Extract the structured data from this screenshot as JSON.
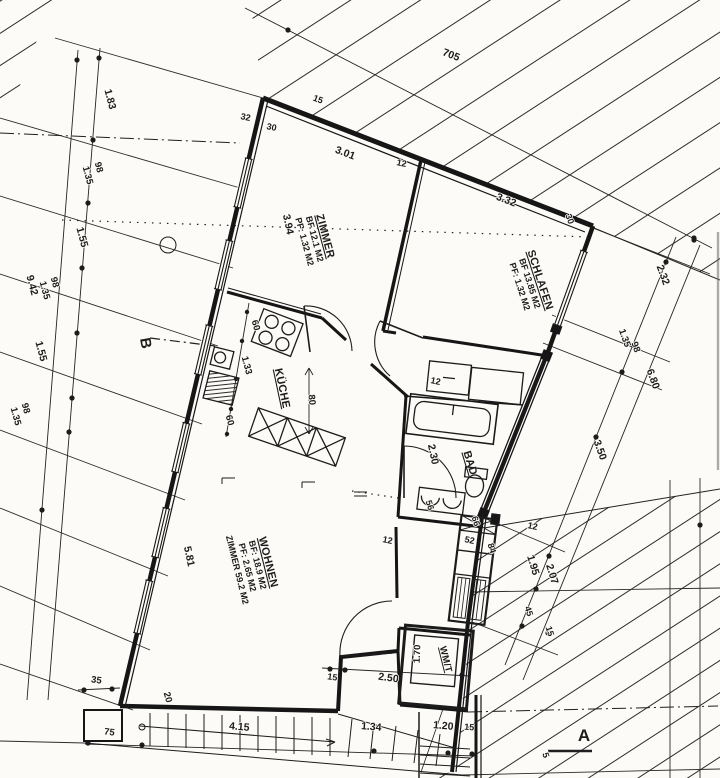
{
  "drawing": {
    "type": "apartment floor plan (scanned blueprint)",
    "ink_color": "#1c1c1c",
    "paper_color": "#fcfbf8"
  },
  "rooms": [
    {
      "id": "zimmer",
      "name": "ZIMMER",
      "lines": [
        "ZIMMER",
        "BF 12.1 M2",
        "PF: 1.32 M2"
      ],
      "x": 322,
      "y": 237,
      "r": 75
    },
    {
      "id": "schlafen",
      "name": "SCHLAFEN",
      "lines": [
        "SCHLAFEN",
        "BF 13.85 M2",
        "PF: 1.32 M2"
      ],
      "x": 537,
      "y": 281,
      "r": 72
    },
    {
      "id": "kueche",
      "name": "KÜCHE",
      "lines": [
        "KÜCHE"
      ],
      "x": 279,
      "y": 389,
      "r": 78
    },
    {
      "id": "bad",
      "name": "BAD",
      "lines": [
        "BAD"
      ],
      "x": 467,
      "y": 464,
      "r": 73
    },
    {
      "id": "wohnen",
      "name": "WOHNEN",
      "lines": [
        "WOHNEN",
        "BF: 18.9 M2",
        "PF: 2.65 M2",
        "ZIMMER 59.2 M2"
      ],
      "x": 265,
      "y": 563,
      "r": 76
    },
    {
      "id": "wmt",
      "name": "WM/T",
      "lines": [
        "WM/T"
      ],
      "x": 443,
      "y": 660,
      "r": 76,
      "fs": 9.5
    }
  ],
  "dims": [
    {
      "t": "705",
      "x": 450,
      "y": 58,
      "r": 21
    },
    {
      "t": "15",
      "x": 317,
      "y": 102,
      "r": 21,
      "fs": 9
    },
    {
      "t": "32",
      "x": 245,
      "y": 120,
      "r": 12,
      "fs": 9
    },
    {
      "t": "30",
      "x": 271,
      "y": 130,
      "r": 12,
      "fs": 9
    },
    {
      "t": "3.01",
      "x": 344,
      "y": 156,
      "r": 21
    },
    {
      "t": "12",
      "x": 401,
      "y": 166,
      "r": 12,
      "fs": 9
    },
    {
      "t": "3.32",
      "x": 505,
      "y": 203,
      "r": 21
    },
    {
      "t": "30",
      "x": 567,
      "y": 220,
      "r": 70,
      "fs": 9
    },
    {
      "t": "3.94",
      "x": 285,
      "y": 225,
      "r": 78
    },
    {
      "t": "2.32",
      "x": 660,
      "y": 276,
      "r": 70
    },
    {
      "t": "1.35",
      "x": 622,
      "y": 339,
      "r": 70,
      "fs": 9.5
    },
    {
      "t": "98",
      "x": 633,
      "y": 348,
      "r": 70,
      "fs": 9.5
    },
    {
      "t": "6.80",
      "x": 650,
      "y": 380,
      "r": 70
    },
    {
      "t": "3.50",
      "x": 597,
      "y": 451,
      "r": 70
    },
    {
      "t": "1.95",
      "x": 530,
      "y": 566,
      "r": 73
    },
    {
      "t": "2.07",
      "x": 549,
      "y": 575,
      "r": 73
    },
    {
      "t": "12",
      "x": 532,
      "y": 529,
      "r": 12,
      "fs": 9
    },
    {
      "t": "45",
      "x": 526,
      "y": 612,
      "r": 73,
      "fs": 9
    },
    {
      "t": "15",
      "x": 547,
      "y": 632,
      "r": 73,
      "fs": 9
    },
    {
      "t": "1.83",
      "x": 107,
      "y": 100,
      "r": 75
    },
    {
      "t": "98",
      "x": 96,
      "y": 168,
      "r": 75,
      "fs": 9.5
    },
    {
      "t": "1.35",
      "x": 85,
      "y": 176,
      "r": 75,
      "fs": 9.5
    },
    {
      "t": "1.55",
      "x": 79,
      "y": 238,
      "r": 75
    },
    {
      "t": "98",
      "x": 52,
      "y": 283,
      "r": 75,
      "fs": 9.5
    },
    {
      "t": "1.35",
      "x": 42,
      "y": 291,
      "r": 75,
      "fs": 9.5
    },
    {
      "t": "9.42",
      "x": 29,
      "y": 286,
      "r": 75
    },
    {
      "t": "1.55",
      "x": 38,
      "y": 352,
      "r": 75
    },
    {
      "t": "98",
      "x": 23,
      "y": 409,
      "r": 75,
      "fs": 9.5
    },
    {
      "t": "1.35",
      "x": 13,
      "y": 417,
      "r": 75,
      "fs": 9.5
    },
    {
      "t": "60",
      "x": 253,
      "y": 326,
      "r": 75,
      "fs": 9.5
    },
    {
      "t": "1.33",
      "x": 244,
      "y": 366,
      "r": 75,
      "fs": 9.5
    },
    {
      "t": "80",
      "x": 309,
      "y": 400,
      "r": 85,
      "fs": 9.5
    },
    {
      "t": "60",
      "x": 227,
      "y": 421,
      "r": 75,
      "fs": 9.5
    },
    {
      "t": "2.30",
      "x": 430,
      "y": 455,
      "r": 78
    },
    {
      "t": "12",
      "x": 435,
      "y": 384,
      "r": 12,
      "fs": 9
    },
    {
      "t": "56",
      "x": 427,
      "y": 506,
      "r": 73,
      "fs": 9
    },
    {
      "t": "5.81",
      "x": 186,
      "y": 557,
      "r": 78
    },
    {
      "t": "12",
      "x": 387,
      "y": 543,
      "r": 12,
      "fs": 9
    },
    {
      "t": "66",
      "x": 473,
      "y": 522,
      "r": 73,
      "fs": 9
    },
    {
      "t": "52",
      "x": 469,
      "y": 543,
      "r": 12,
      "fs": 9
    },
    {
      "t": "84",
      "x": 489,
      "y": 549,
      "r": 73,
      "fs": 9
    },
    {
      "t": "1.70",
      "x": 420,
      "y": 654,
      "r": -88,
      "fs": 9.5
    },
    {
      "t": "35",
      "x": 96,
      "y": 683,
      "r": 8,
      "fs": 9.5
    },
    {
      "t": "20",
      "x": 165,
      "y": 698,
      "r": 75,
      "fs": 9.5
    },
    {
      "t": "75",
      "x": 109,
      "y": 735,
      "r": 8,
      "fs": 9.5
    },
    {
      "t": "4.15",
      "x": 239,
      "y": 730,
      "r": 5
    },
    {
      "t": "1.34",
      "x": 371,
      "y": 730,
      "r": 5
    },
    {
      "t": "1.20",
      "x": 443,
      "y": 729,
      "r": 5
    },
    {
      "t": "15",
      "x": 469,
      "y": 730,
      "r": 5,
      "fs": 9
    },
    {
      "t": "15",
      "x": 332,
      "y": 680,
      "r": 8,
      "fs": 9
    },
    {
      "t": "2.50",
      "x": 388,
      "y": 681,
      "r": 8
    },
    {
      "t": "5",
      "x": 543,
      "y": 756,
      "r": 73,
      "fs": 9
    }
  ],
  "markers": [
    {
      "id": "section-a",
      "t": "A",
      "x": 584,
      "y": 741,
      "r": 0,
      "fs": 17
    },
    {
      "id": "section-b",
      "t": "B",
      "x": 141,
      "y": 344,
      "r": 80,
      "fs": 15
    }
  ]
}
